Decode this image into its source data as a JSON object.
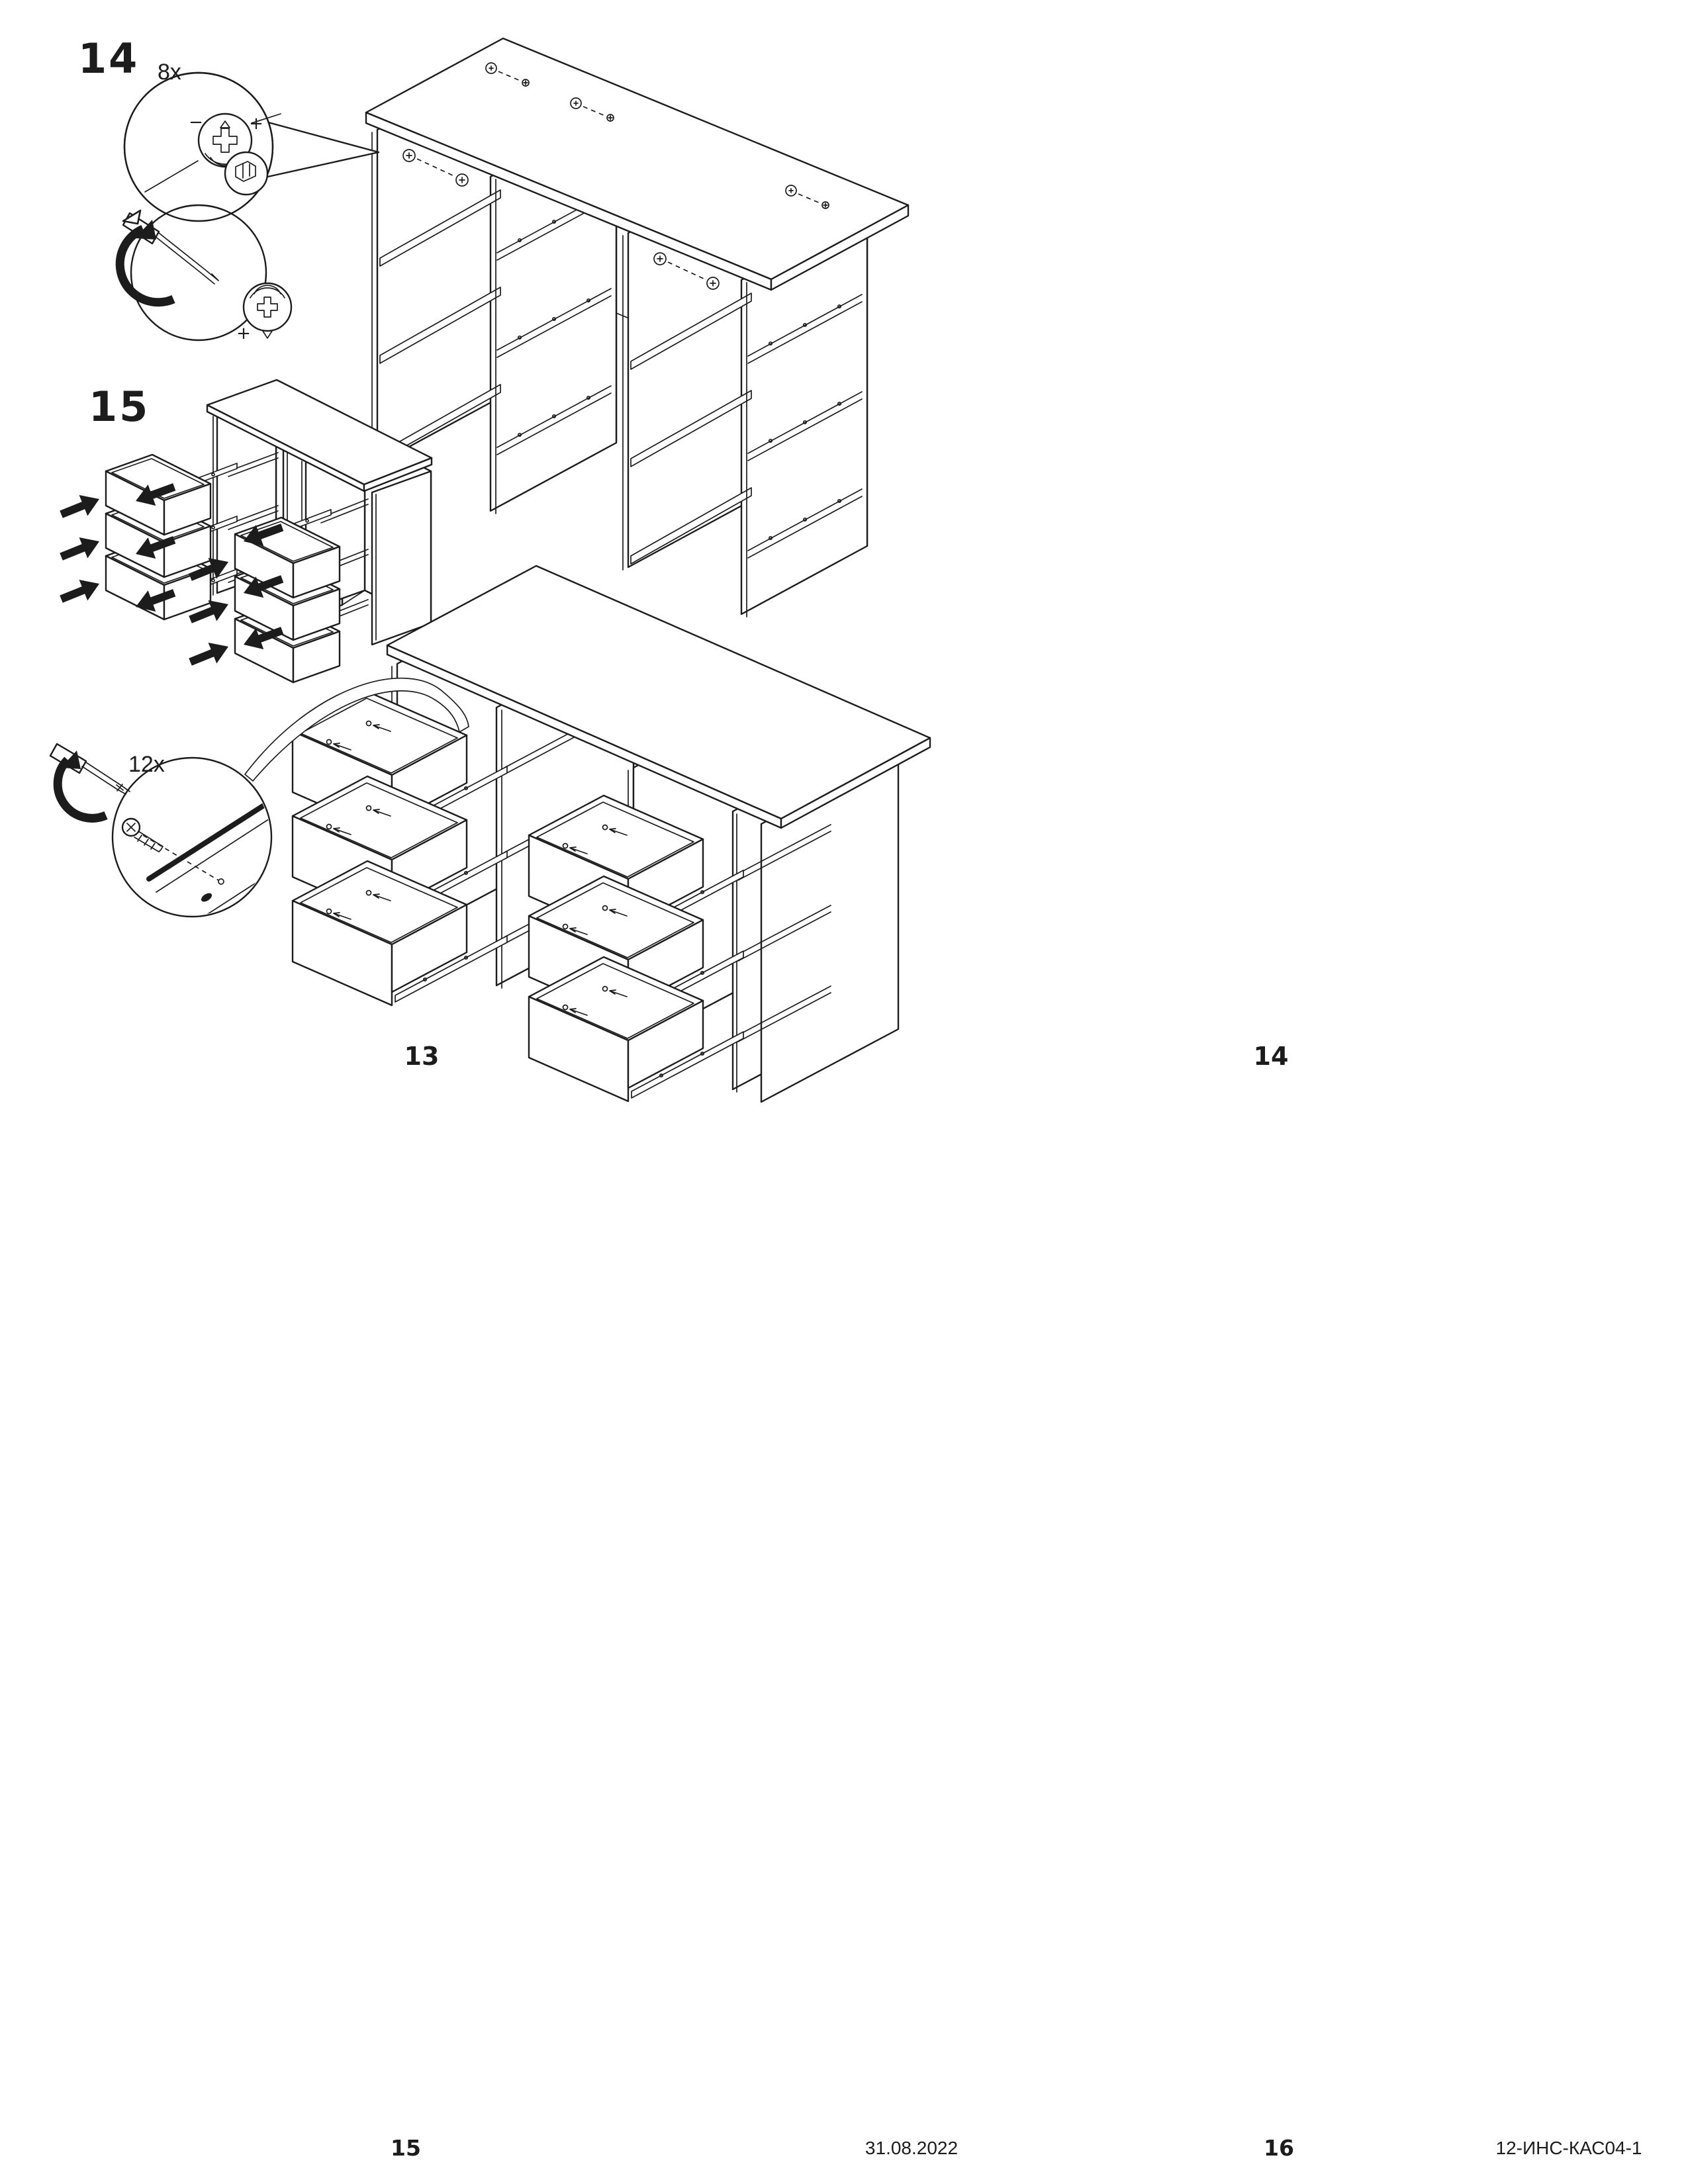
{
  "sheet": {
    "background": "#ffffff",
    "line_color": "#1c1c1c",
    "kind": "furniture-assembly-instructions"
  },
  "steps": {
    "step14": {
      "number": "14",
      "hardware_quantity": "8x"
    },
    "step15": {
      "number": "15",
      "hardware_quantity": "12x"
    }
  },
  "cam_lock_markings": {
    "plus": "+",
    "minus": "−"
  },
  "page_numbers": {
    "upper_left": "13",
    "upper_right": "14",
    "lower_left": "15",
    "lower_right": "16"
  },
  "footer": {
    "date": "31.08.2022",
    "document_code": "12-ИНС-КАС04-1"
  },
  "icons": {
    "cam_lock_front": "cam-lock-front-icon",
    "cam_lock_side": "cam-lock-side-icon",
    "screwdriver": "screwdriver-icon",
    "rotation_arrow": "rotation-arrow-icon",
    "screw": "screw-icon",
    "insertion_arrow": "insertion-arrow-icon"
  }
}
